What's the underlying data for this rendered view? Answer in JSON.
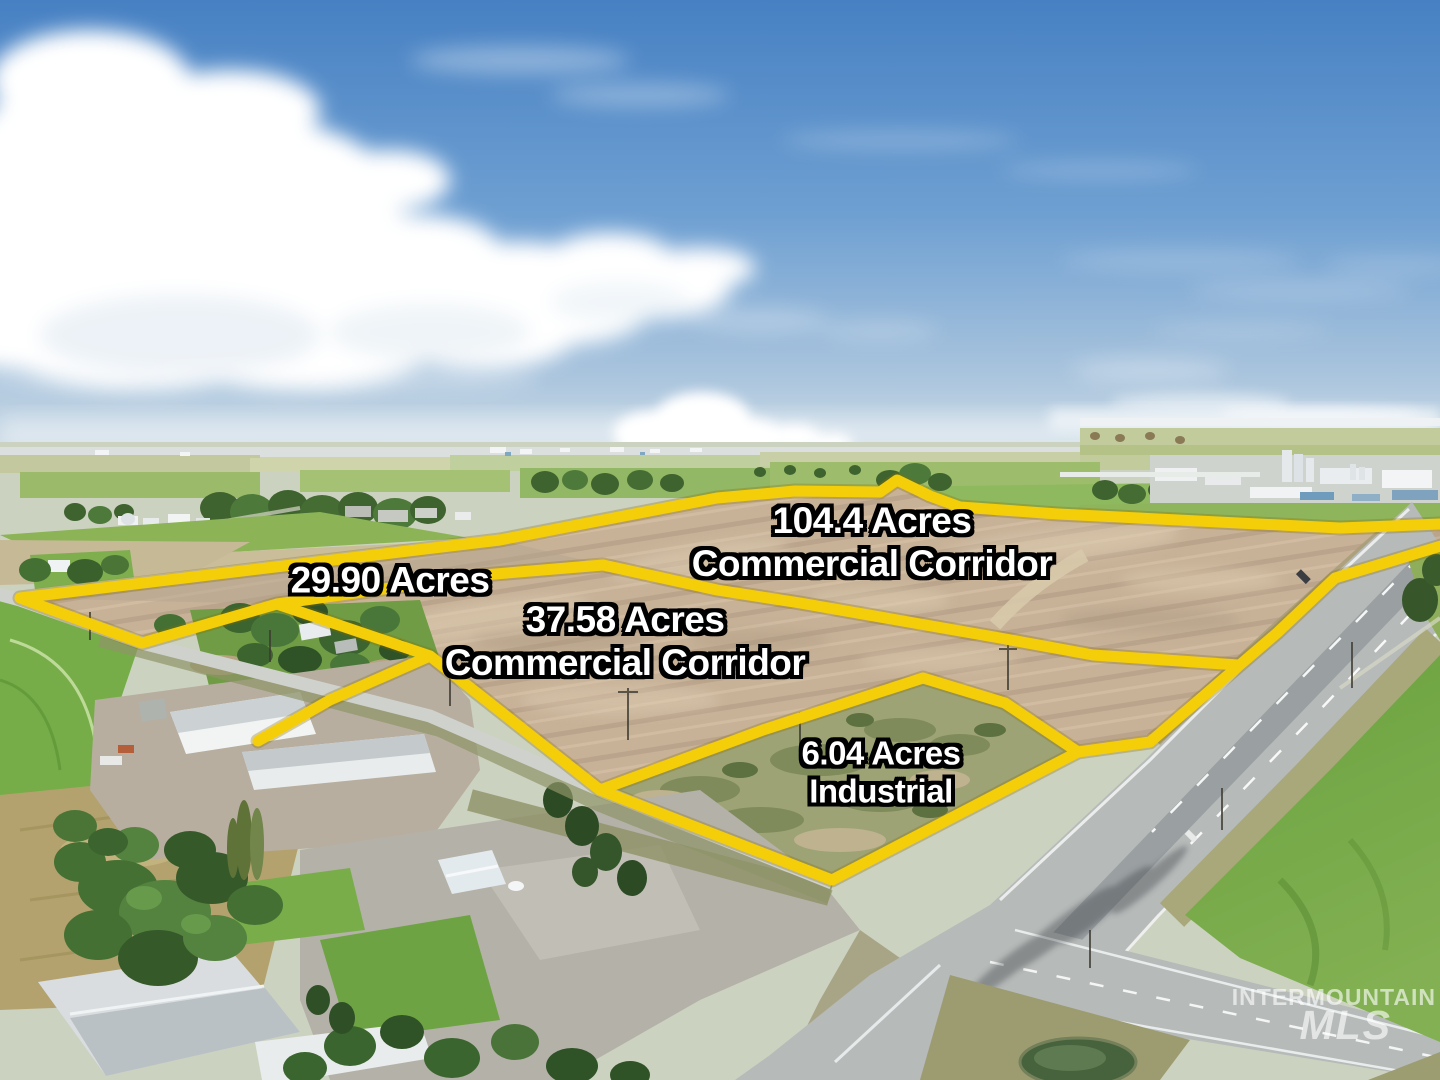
{
  "parcels": [
    {
      "name": "commercial-corridor-104",
      "acres": "104.4 Acres",
      "use": "Commercial Corridor"
    },
    {
      "name": "parcel-29-90",
      "acres": "29.90 Acres",
      "use": ""
    },
    {
      "name": "commercial-corridor-3758",
      "acres": "37.58 Acres",
      "use": "Commercial Corridor"
    },
    {
      "name": "industrial-6-04",
      "acres": "6.04 Acres",
      "use": "Industrial"
    }
  ],
  "watermark": {
    "line1": "INTERMOUNTAIN",
    "line2": "MLS"
  },
  "colors": {
    "boundary_yellow": "#f4ce09",
    "label_text": "#ffffff",
    "label_outline": "#000000",
    "sky_top": "#4781c3",
    "field_tan": "#c7b298",
    "corn_green": "#6aa23f",
    "highway_gray": "#b6bab9"
  }
}
